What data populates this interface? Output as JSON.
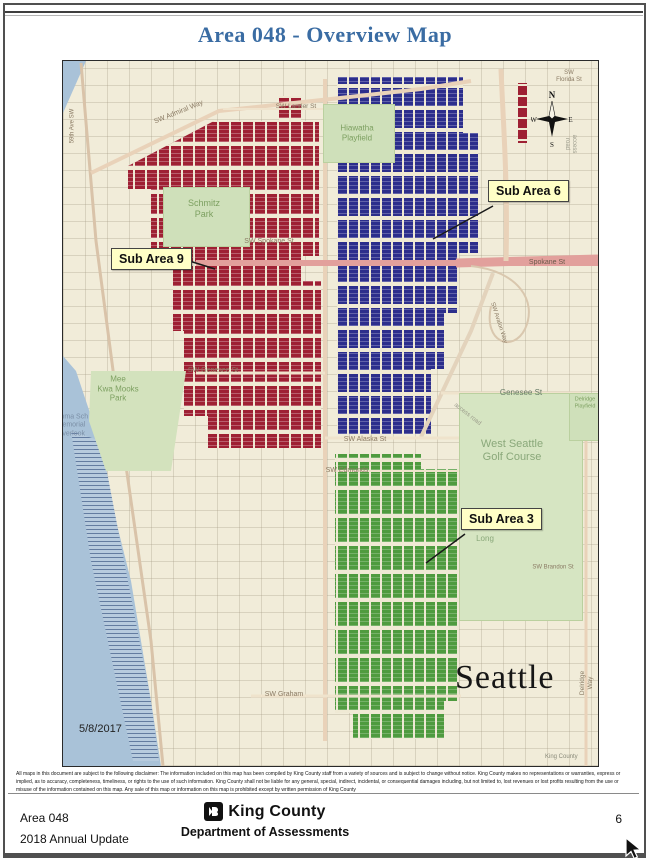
{
  "title": "Area 048 - Overview Map",
  "map": {
    "date": "5/8/2017",
    "city": "Seattle",
    "map_attribution": "King County",
    "compass": {
      "n": "N",
      "e": "E",
      "s": "S",
      "w": "W"
    },
    "callouts": [
      {
        "id": "sub-area-9",
        "label": "Sub Area 9",
        "color": "#9e2033"
      },
      {
        "id": "sub-area-6",
        "label": "Sub Area 6",
        "color": "#2c2e8c"
      },
      {
        "id": "sub-area-3",
        "label": "Sub Area 3",
        "color": "#4f9b3f"
      }
    ],
    "parks": [
      {
        "id": "schmitz-park",
        "label": "Schmitz\nPark"
      },
      {
        "id": "hiawatha-playfield",
        "label": "Hiawatha\nPlayfield"
      },
      {
        "id": "mee-kwa-mooks-park",
        "label": "Mee\nKwa Mooks\nPark"
      },
      {
        "id": "emma-schmitz-memorial-overlook",
        "label": "Emma Sch\nMemorial\nOverlook"
      },
      {
        "id": "west-seattle-golf-course",
        "label": "West Seattle\nGolf Course"
      },
      {
        "id": "delridge-playfield",
        "label": "Delridge\nPlayfield"
      },
      {
        "id": "camp-long",
        "label": "Long"
      }
    ],
    "streets": [
      {
        "label": "SW Admiral Way"
      },
      {
        "label": "59th Ave SW"
      },
      {
        "label": "SW Lander St"
      },
      {
        "label": "SW Spokane St"
      },
      {
        "label": "Spokane St"
      },
      {
        "label": "SW Genesee St"
      },
      {
        "label": "Genesee St"
      },
      {
        "label": "SW Alaska St"
      },
      {
        "label": "SW Edmunds"
      },
      {
        "label": "SW Brandon St"
      },
      {
        "label": "SW Graham"
      },
      {
        "label": "SW Florida St"
      },
      {
        "label": "access road"
      },
      {
        "label": "access road"
      },
      {
        "label": "SW Avalon Way"
      },
      {
        "label": "Delridge Way"
      }
    ],
    "colors": {
      "water": "#a9c2d8",
      "land": "#f1ecd9",
      "park_green": "#cfe0ba",
      "golf_green": "#d6e5c2",
      "sub_area_9": "#9e2033",
      "sub_area_6": "#2c2e8c",
      "sub_area_3": "#4f9b3f",
      "callout_bg": "#ffffc6",
      "title_blue": "#3a6ca3"
    }
  },
  "disclaimer": "All maps in this document are subject to the following disclaimer: The information included on this map has been compiled by King County staff from a variety of sources and is subject to change without notice.  King County makes no representations or warranties, express or implied, as to accuracy, completeness, timeliness, or rights to the use of such information.  King County shall not be liable for any general, special, indirect, incidental, or consequential damages including, but not limited to, lost revenues or lost profits resulting from the use or misuse of the information contained on this map.  Any sale of this map or information on this map is prohibited except by written permission of King County",
  "footer": {
    "area_line1": "Area 048",
    "area_line2": "2018 Annual Update",
    "org_name": "King County",
    "dept_name": "Department of Assessments",
    "page_number": "6"
  }
}
